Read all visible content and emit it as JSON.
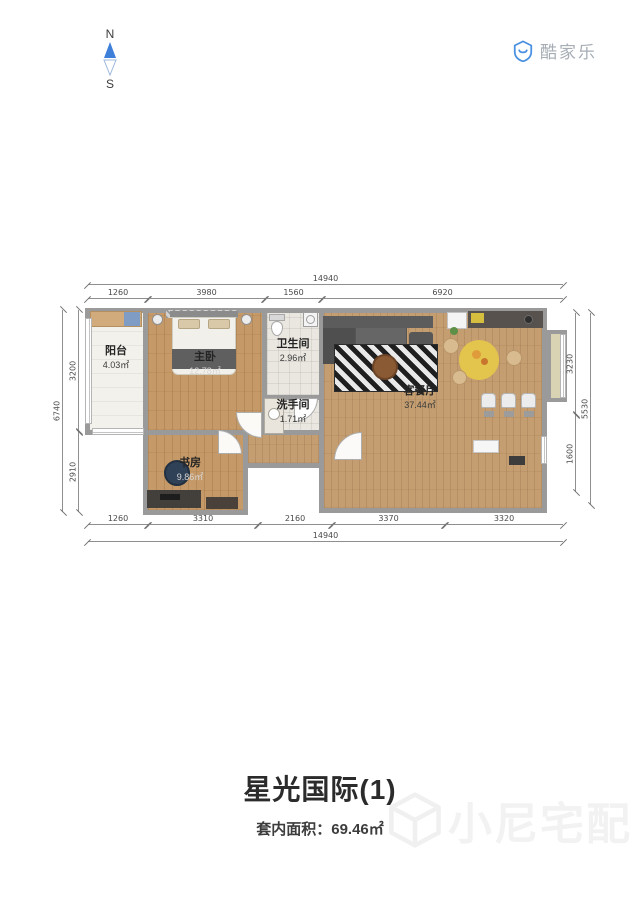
{
  "compass": {
    "north": "N",
    "south": "S"
  },
  "logo": {
    "text": "酷家乐"
  },
  "plan": {
    "rooms": [
      {
        "id": "balcony",
        "name": "阳台",
        "area": "4.03㎡"
      },
      {
        "id": "master-bedroom",
        "name": "主卧",
        "area": "12.78㎡"
      },
      {
        "id": "bathroom",
        "name": "卫生间",
        "area": "2.96㎡"
      },
      {
        "id": "washroom",
        "name": "洗手间",
        "area": "1.71㎡"
      },
      {
        "id": "living-dining",
        "name": "客餐厅",
        "area": "37.44㎡"
      },
      {
        "id": "study",
        "name": "书房",
        "area": "9.86㎡"
      }
    ],
    "dimensions": {
      "top": {
        "total": "14940",
        "segments": [
          "1260",
          "3980",
          "1560",
          "6920"
        ]
      },
      "bottom": {
        "total": "14940",
        "segments": [
          "1260",
          "3310",
          "2160",
          "3370",
          "3320"
        ]
      },
      "left": {
        "total": "6740",
        "segments": [
          "3200",
          "2910"
        ]
      },
      "right": {
        "total": "5530",
        "segments": [
          "3230",
          "1600"
        ]
      }
    }
  },
  "footer": {
    "title": "星光国际(1)",
    "area_label": "套内面积：",
    "area_value": "69.46㎡"
  },
  "watermark": {
    "text": "小尼宅配"
  },
  "colors": {
    "compass_blue": "#3d7fd9",
    "logo_blue": "#4a90e2",
    "wall_gray": "#9a9a9a",
    "wood_floor": "#c69a68",
    "rug_yellow": "#e3c44c",
    "title_text": "#2b2b2b"
  }
}
